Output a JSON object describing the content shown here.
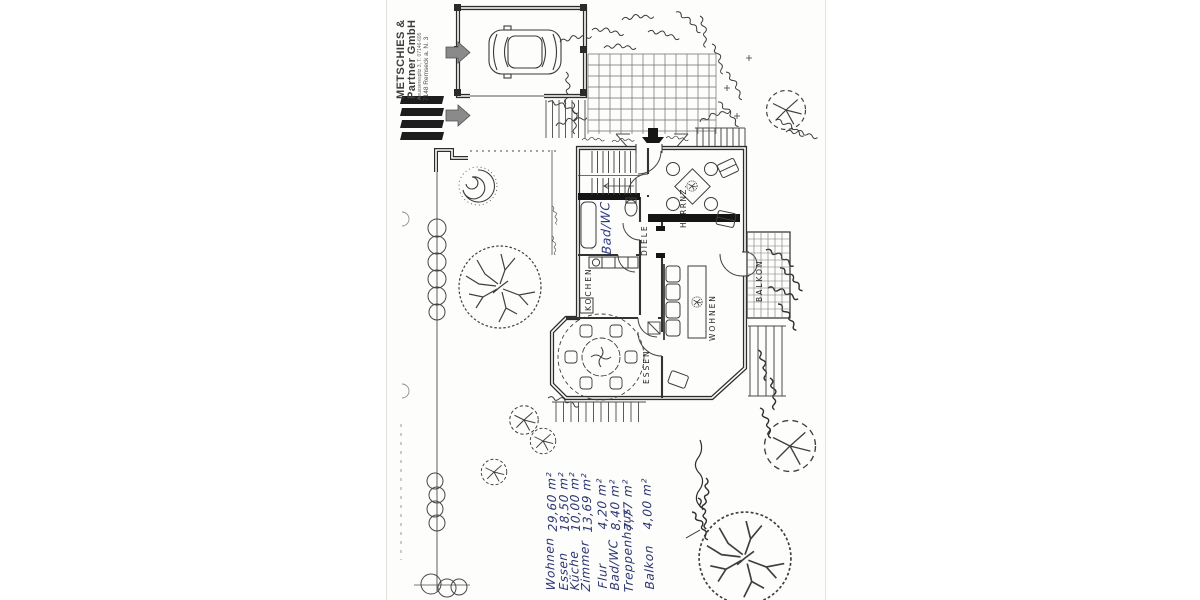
{
  "stamp": {
    "company_line1": "METSCHIES &",
    "company_line2": "Partner GmbH",
    "address_line": "Aeusserespltz 3, T. 07146-695",
    "city_line": "7148 Remseck a. N. 3"
  },
  "plan_labels": {
    "herrenzimmer": "HERRNZ.",
    "bad_wc": "Bad/WC",
    "diele": "DIELE",
    "kochen": "KOCHEN",
    "essen": "ESSEN",
    "wohnen": "WOHNEN",
    "balkon": "BALKON"
  },
  "area_table": {
    "items": [
      {
        "label": "Wohnen",
        "area": "29,60 m²"
      },
      {
        "label": "Essen",
        "area": "18,50 m²"
      },
      {
        "label": "Küche",
        "area": "10,00 m²"
      },
      {
        "label": "Zimmer",
        "area": "13,69 m²"
      },
      {
        "label": "Flur",
        "area": "4,20 m²"
      },
      {
        "label": "Bad/WC",
        "area": "8,40 m²"
      },
      {
        "label": "Treppenhaus",
        "area": "7,77 m²"
      },
      {
        "label": "Balkon",
        "area": "4,00 m²"
      }
    ]
  },
  "colors": {
    "handwriting_ink": "#2b3470",
    "plan_line": "#3a3a3a",
    "wall_black": "#151515",
    "stamp_gray": "#3d3d3d",
    "paper": "#fdfdfb"
  }
}
